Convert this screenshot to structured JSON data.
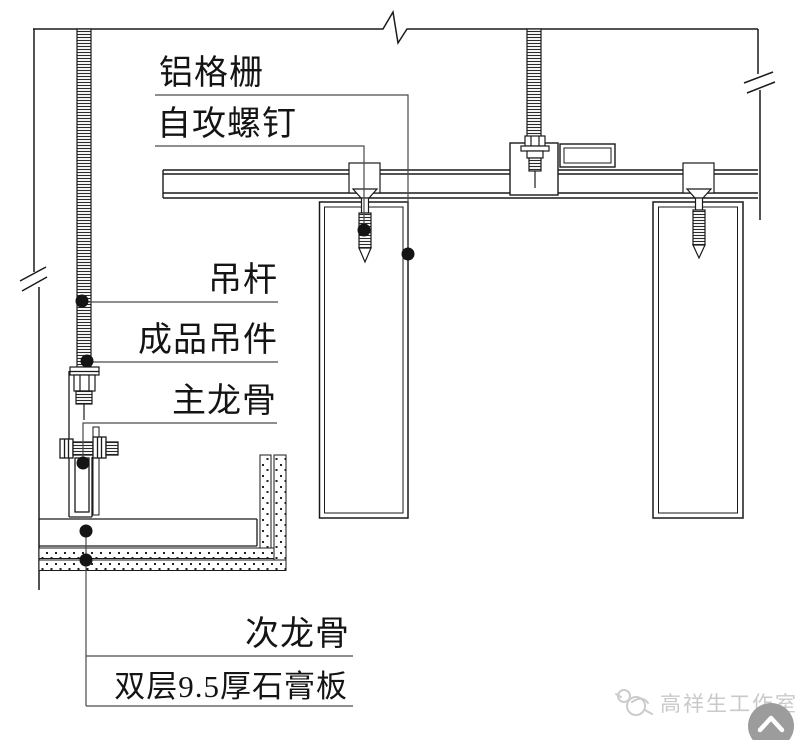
{
  "diagram": {
    "type": "construction-detail",
    "callouts": [
      {
        "id": "aluminum-grille",
        "text": "铝格栅"
      },
      {
        "id": "self-tapping-screw",
        "text": "自攻螺钉"
      },
      {
        "id": "hanger-rod",
        "text": "吊杆"
      },
      {
        "id": "finished-hanger",
        "text": "成品吊件"
      },
      {
        "id": "main-runner",
        "text": "主龙骨"
      },
      {
        "id": "secondary-runner",
        "text": "次龙骨"
      },
      {
        "id": "gypsum-board",
        "text": "双层9.5厚石膏板"
      }
    ],
    "colors": {
      "line": "#1a1a1a",
      "leader": "#4a4a4a",
      "dot": "#141414",
      "watermark_text": "#c9c9c9",
      "button_bg": "#9c9c9c"
    }
  },
  "watermark": {
    "studio_name": "高祥生工作室",
    "logo": "bird-logo"
  },
  "back_to_top": {
    "icon": "chevron-up-icon"
  }
}
